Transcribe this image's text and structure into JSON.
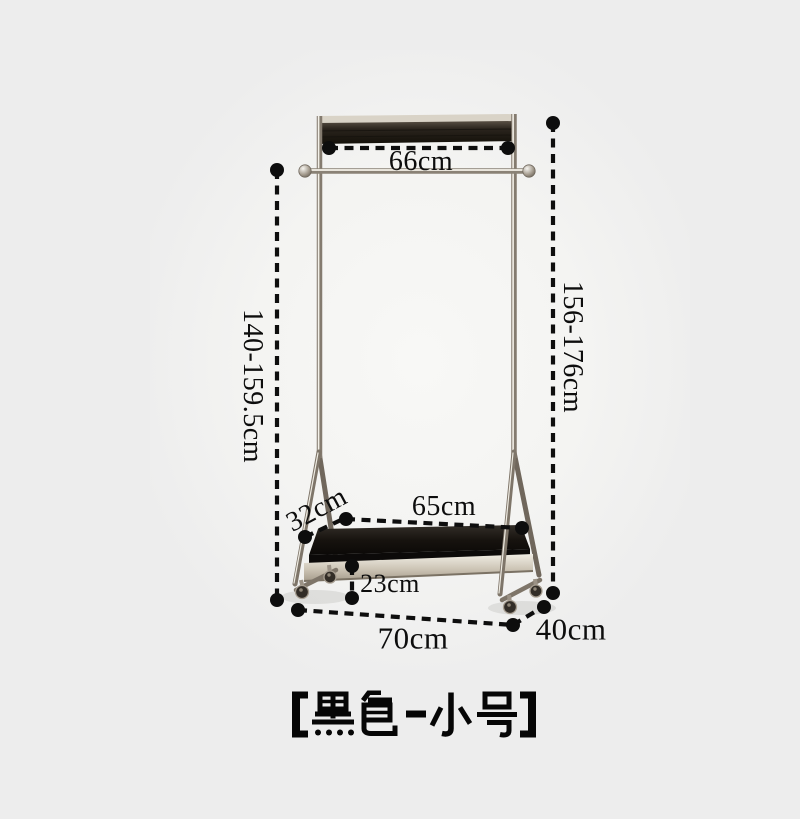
{
  "meta": {
    "background": "#ededed",
    "ink": "#0d0d0d"
  },
  "rack": {
    "kind": "rolling garment rack with bottom tray",
    "colors": {
      "wood_bar": "#1c1713",
      "chrome": "#8b8277",
      "tray": "#14100d",
      "apron_metal": "#c9c1b2"
    }
  },
  "dimensions": {
    "top_width": "66cm",
    "rod_height": "140-159.5cm",
    "total_height": "156-176cm",
    "tray_width": "65cm",
    "tray_depth": "32cm",
    "tray_height": "23cm",
    "base_width": "70cm",
    "base_depth": "40cm"
  },
  "caption": {
    "variant": "【黑色-小号】"
  }
}
